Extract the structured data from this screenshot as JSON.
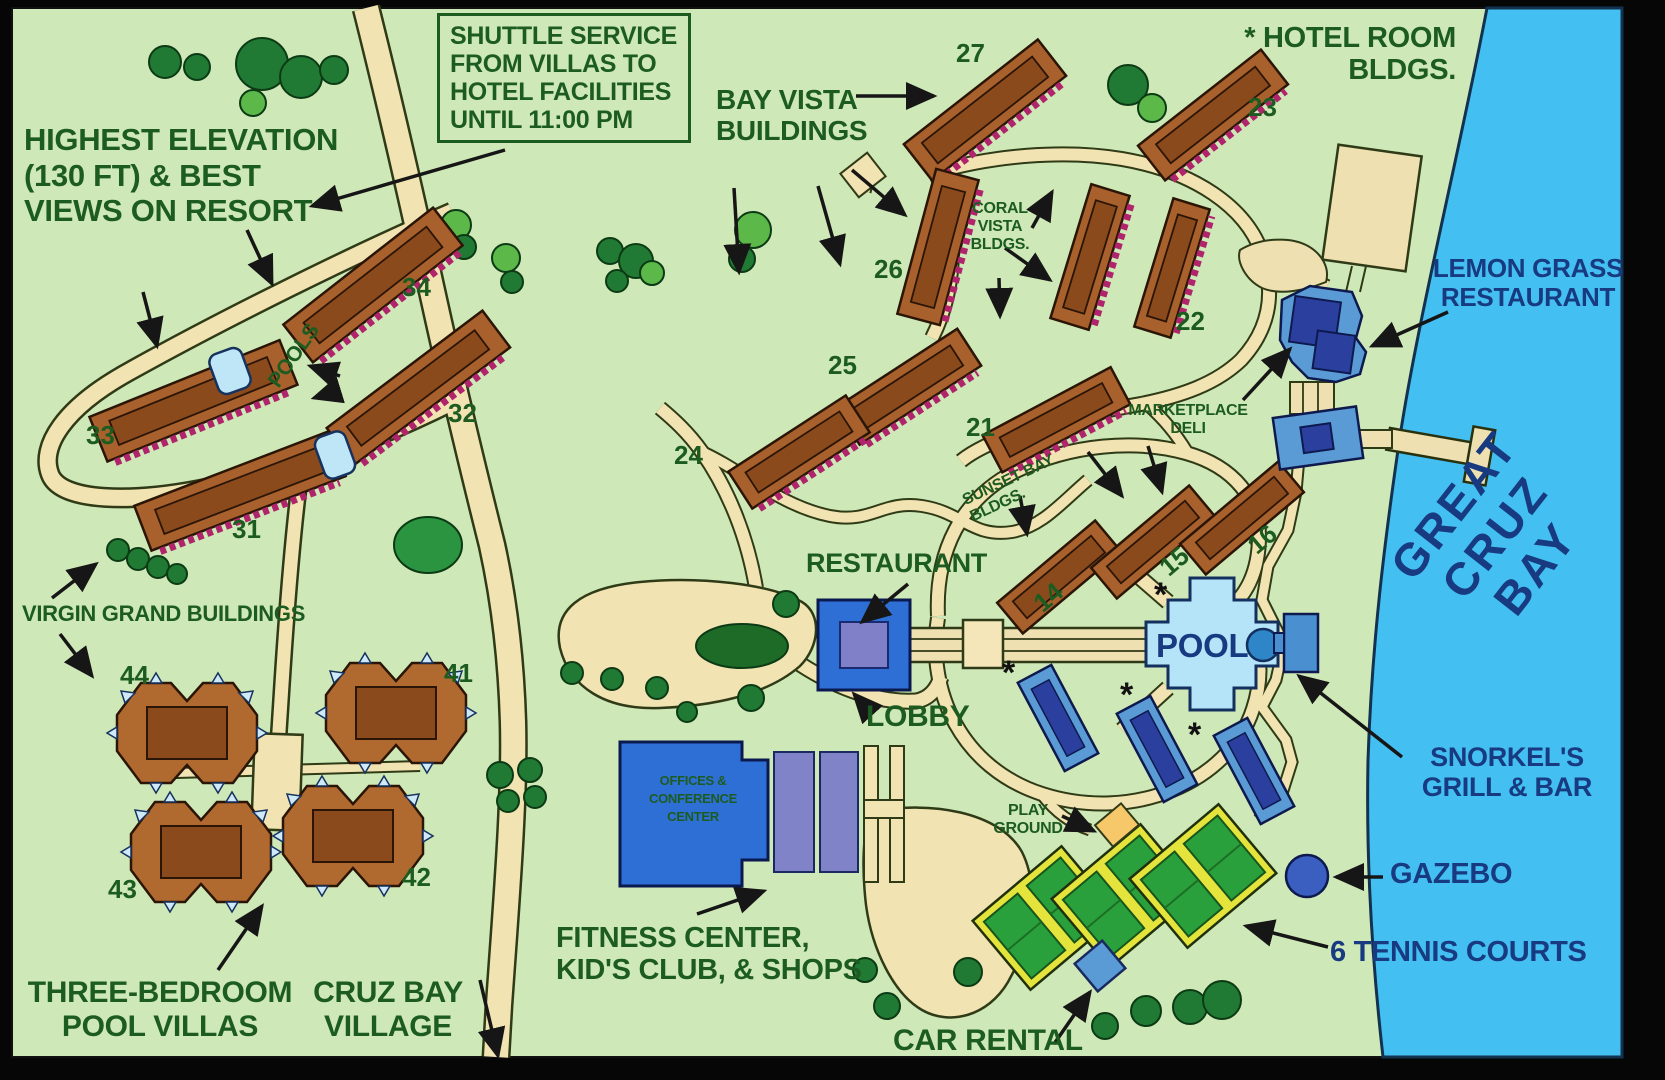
{
  "map": {
    "title": "resort site map",
    "labels": {
      "shuttle": "SHUTTLE SERVICE\nFROM VILLAS TO\nHOTEL FACILITIES\nUNTIL 11:00 PM",
      "highest_elevation": "HIGHEST ELEVATION\n(130 FT) & BEST\nVIEWS ON RESORT",
      "bay_vista": "BAY VISTA\nBUILDINGS",
      "hotel_room": "* HOTEL ROOM\nBLDGS.",
      "coral_vista": "CORAL\nVISTA\nBLDGS.",
      "lemon_grass": "LEMON GRASS\nRESTAURANT",
      "great_cruz_bay": "GREAT CRUZ\nBAY",
      "marketplace_deli": "MARKETPLACE\nDELI",
      "sunset_bay": "SUNSET BAY BLDGS.",
      "restaurant": "RESTAURANT",
      "lobby": "LOBBY",
      "pool": "POOL",
      "pools": "POOLS",
      "virgin_grand": "VIRGIN GRAND BUILDINGS",
      "offices": "OFFICES &\nCONFERENCE\nCENTER",
      "fitness": "FITNESS CENTER,\nKID'S CLUB, & SHOPS",
      "snorkels": "SNORKEL'S\nGRILL & BAR",
      "playground": "PLAY\nGROUND",
      "gazebo": "GAZEBO",
      "tennis": "6 TENNIS COURTS",
      "car_rental": "CAR RENTAL",
      "three_bedroom": "THREE-BEDROOM\nPOOL VILLAS",
      "cruz_bay_village": "CRUZ BAY\nVILLAGE",
      "asterisk": "*"
    },
    "building_numbers": {
      "14": "14",
      "15": "15",
      "16": "16",
      "21": "21",
      "22": "22",
      "23": "23",
      "24": "24",
      "25": "25",
      "26": "26",
      "27": "27",
      "31": "31",
      "32": "32",
      "33": "33",
      "34": "34",
      "41": "41",
      "42": "42",
      "43": "43",
      "44": "44"
    },
    "colors": {
      "land": "#cfe8b8",
      "bay": "#44bff2",
      "road": "#f2e3b2",
      "road_outline": "#2f3a16",
      "building_brown": "#a8602c",
      "building_inner": "#8a4a1c",
      "balcony_trim": "#b0246b",
      "hotel_blue": "#5b9bd5",
      "hotel_inner": "#2a3f9e",
      "pool_blue": "#b5e4f8",
      "text_green": "#1d5c20",
      "text_navy": "#173a80",
      "tennis_green": "#2aa03c",
      "tennis_yellow": "#e4e43c",
      "tree_dark": "#217a33",
      "tree_light": "#5cb848"
    }
  }
}
